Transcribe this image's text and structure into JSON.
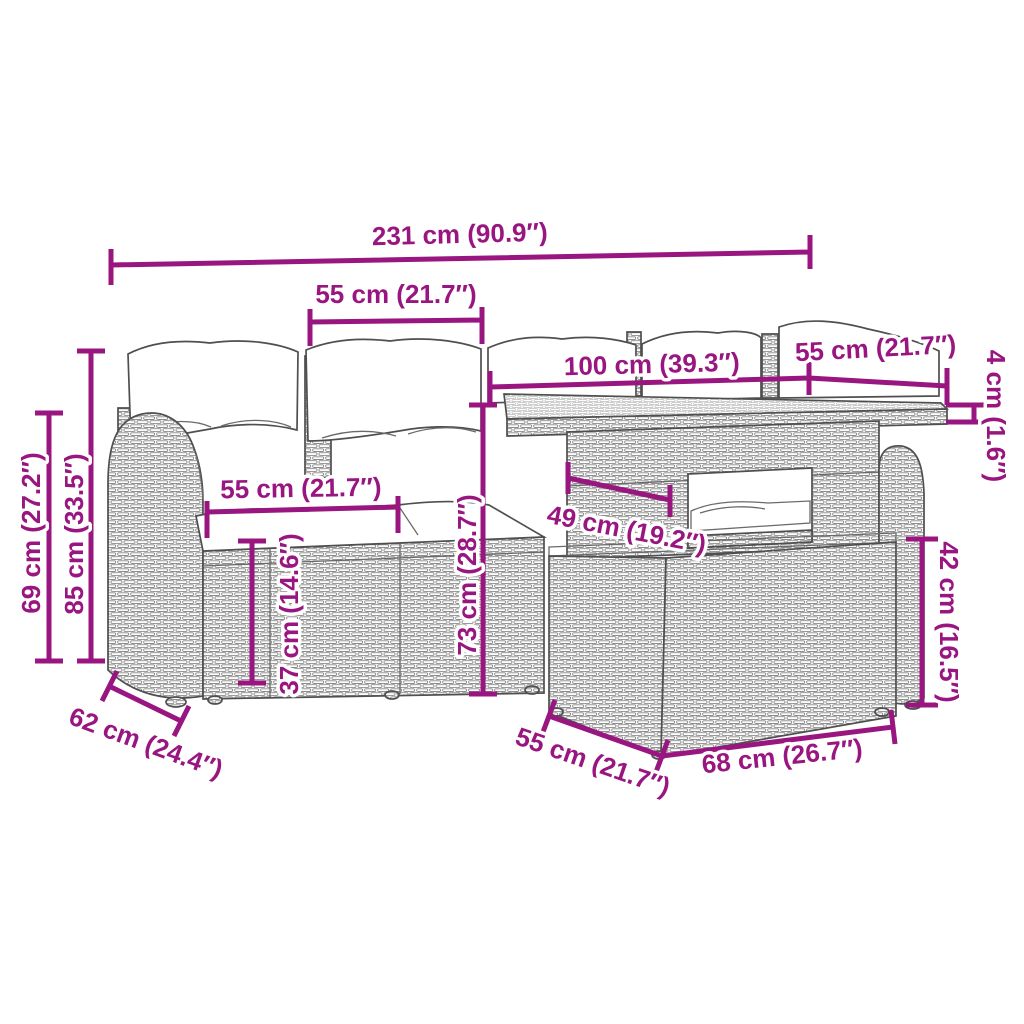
{
  "diagram_type": "furniture-dimension-line-drawing",
  "product": "rattan-garden-lounge-set-with-adjustable-table-and-ottoman",
  "colors": {
    "dimension_annotation": "#991680",
    "furniture_outline": "#4f4f4f",
    "wicker_line": "#8d8d8d",
    "cushion": "#ffffff",
    "background": "#ffffff"
  },
  "dims": {
    "overall_width": {
      "label": "231 cm (90.9″)"
    },
    "backrest_section_width": {
      "label": "55 cm (21.7″)"
    },
    "table_top_length": {
      "label": "100 cm (39.3″)"
    },
    "table_top_width": {
      "label": "55 cm (21.7″)"
    },
    "table_top_thickness": {
      "label": "4 cm (1.6″)"
    },
    "armrest_height": {
      "label": "69 cm (27.2″)"
    },
    "back_height": {
      "label": "85 cm (33.5″)"
    },
    "seat_width": {
      "label": "55 cm (21.7″)"
    },
    "seat_height": {
      "label": "37 cm (14.6″)"
    },
    "table_height": {
      "label": "73 cm (28.7″)"
    },
    "table_shelf_width": {
      "label": "49 cm (19.2″)"
    },
    "ottoman_height": {
      "label": "42 cm (16.5″)"
    },
    "armrest_depth": {
      "label": "62 cm (24.4″)"
    },
    "ottoman_depth": {
      "label": "55 cm (21.7″)"
    },
    "ottoman_width": {
      "label": "68 cm (26.7″)"
    }
  }
}
